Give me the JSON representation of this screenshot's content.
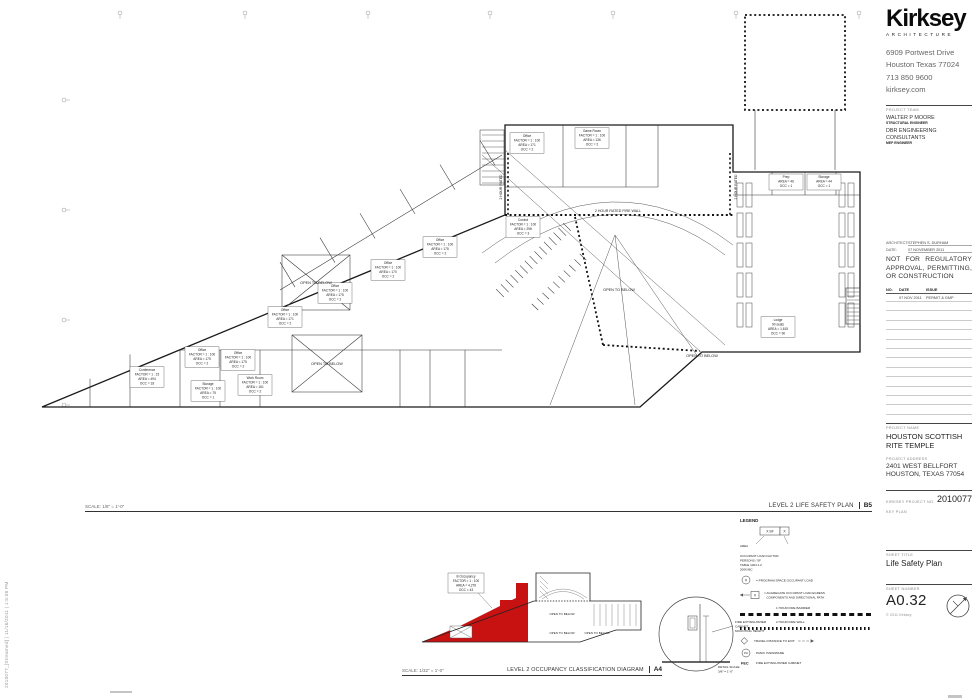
{
  "sheet": {
    "plot_stamp": "2010077_[Streamed] | 11/16/2011 | 1:5:08 PM",
    "copyright": "© 2011 Kirksey"
  },
  "firm": {
    "logo": "Kirksey",
    "logo_sub": "ARCHITECTURE",
    "address_lines": [
      "6909 Portwest Drive",
      "Houston Texas 77024",
      "713 850 9600",
      "kirksey.com"
    ]
  },
  "team": {
    "label": "PROJECT TEAM",
    "members": [
      {
        "name": "WALTER P MOORE",
        "role": "STRUCTURAL ENGINEER"
      },
      {
        "name": "DBR ENGINEERING CONSULTANTS",
        "role": "MEP ENGINEER"
      }
    ]
  },
  "stamp": {
    "architect_label": "ARCHITECT:",
    "architect": "STEPHEN S. DURHAM",
    "date_label": "DATE:",
    "date": "07 NOVEMBER 2011",
    "notice": "NOT FOR REGULATORY APPROVAL, PERMITTING, OR CONSTRUCTION"
  },
  "issues": {
    "headers": [
      "NO.",
      "DATE",
      "ISSUE"
    ],
    "rows": [
      {
        "no": "",
        "date": "07 NOV 2011",
        "issue": "PERMIT & GMP"
      }
    ],
    "blank_rows": 12
  },
  "project": {
    "name_label": "PROJECT NAME",
    "name": "HOUSTON SCOTTISH RITE TEMPLE",
    "address_label": "PROJECT ADDRESS",
    "address_lines": [
      "2401 WEST BELLFORT",
      "HOUSTON, TEXAS 77054"
    ],
    "number_label": "KIRKSEY PROJECT NO.",
    "number": "2010077",
    "key_plan_label": "KEY PLAN"
  },
  "sheet_info": {
    "title_label": "SHEET TITLE",
    "title": "Life Safety Plan",
    "number_label": "SHEET NUMBER",
    "number": "A0.32"
  },
  "main_plan": {
    "title": "LEVEL 2 LIFE SAFETY PLAN",
    "ref": "B5",
    "scale": "SCALE: 1/8\" = 1'-0\"",
    "fire_wall_label": "2 HOUR RATED FIRE WALL",
    "fire_rated_side_label": "2 HOUR RATED",
    "open_to_below_label": "OPEN TO BELOW",
    "rooms": [
      {
        "x": 117,
        "y": 372,
        "lines": [
          "Conference",
          "FACTOR = 1 : 15",
          "AREA = 494",
          "OCC = 33"
        ]
      },
      {
        "x": 172,
        "y": 352,
        "lines": [
          "Office",
          "FACTOR = 1 : 100",
          "AREA = 175",
          "OCC = 2"
        ]
      },
      {
        "x": 208,
        "y": 355,
        "lines": [
          "Office",
          "FACTOR = 1 : 100",
          "AREA = 175",
          "OCC = 2"
        ]
      },
      {
        "x": 225,
        "y": 380,
        "lines": [
          "Work Room",
          "FACTOR = 1 : 100",
          "AREA = 161",
          "OCC = 2"
        ]
      },
      {
        "x": 178,
        "y": 386,
        "lines": [
          "Storage",
          "FACTOR = 1 : 100",
          "AREA = 75",
          "OCC = 1"
        ]
      },
      {
        "x": 255,
        "y": 312,
        "lines": [
          "Office",
          "FACTOR = 1 : 100",
          "AREA = 171",
          "OCC = 2"
        ]
      },
      {
        "x": 305,
        "y": 288,
        "lines": [
          "Office",
          "FACTOR = 1 : 100",
          "AREA = 175",
          "OCC = 2"
        ]
      },
      {
        "x": 358,
        "y": 265,
        "lines": [
          "Office",
          "FACTOR = 1 : 100",
          "AREA = 170",
          "OCC = 2"
        ]
      },
      {
        "x": 410,
        "y": 242,
        "lines": [
          "Office",
          "FACTOR = 1 : 100",
          "AREA = 175",
          "OCC = 2"
        ]
      },
      {
        "x": 497,
        "y": 138,
        "lines": [
          "Office",
          "FACTOR = 1 : 100",
          "AREA = 171",
          "OCC = 2"
        ]
      },
      {
        "x": 562,
        "y": 133,
        "lines": [
          "Game Room",
          "FACTOR = 1 : 100",
          "AREA = 136",
          "OCC = 2"
        ]
      },
      {
        "x": 493,
        "y": 222,
        "lines": [
          "Control",
          "FACTOR = 1 : 100",
          "AREA = 298",
          "OCC = 3"
        ]
      },
      {
        "x": 748,
        "y": 322,
        "lines": [
          "Lodge",
          "90 seats",
          "AREA = 1,615",
          "OCC = 90"
        ]
      },
      {
        "x": 756,
        "y": 177,
        "lines": [
          "Prep",
          "AREA = 46",
          "OCC = 1"
        ]
      },
      {
        "x": 794,
        "y": 177,
        "lines": [
          "Storage",
          "AREA = 44",
          "OCC = 1"
        ]
      }
    ]
  },
  "occupancy_diagram": {
    "title": "LEVEL 2 OCCUPANCY CLASSIFICATION DIAGRAM",
    "ref": "A4",
    "scale": "SCALE: 1/32\" = 1'-0\"",
    "red_color": "#c81212",
    "b_tag_lines": [
      "B Occupancy",
      "FACTOR = 1 : 100",
      "AREA = 4,276",
      "OCC = 43"
    ],
    "open_to_below_label": "OPEN TO BELOW"
  },
  "legend": {
    "title": "LEGEND",
    "tag_left": "X SF",
    "tag_right": "X",
    "tag_arrow_label": "AREA",
    "tag_note_lines": [
      "OCCUPANT LOAD FACTOR",
      "PERSONS / SF",
      "TABLE 1004.1.2",
      "2006 IBC"
    ],
    "program_symbol": "#",
    "program_label": "= PROGRAM SPACE OCCUPANT LOAD",
    "aggregate_symbol": "#",
    "aggregate_label_lines": [
      "= AGGREGATE OCCUPANT LOAD EGRESS",
      "COMPONENTS AND DIRECTIONAL PATH"
    ],
    "fire_barrier_label": "1 HOUR FIRE BARRIER",
    "fire_wall_label": "2 HOUR FIRE WALL",
    "travel_label": "TRAVEL DISTANCE TO EXIT",
    "panic_symbol": "PH",
    "panic_label": "PANIC HARDWARE",
    "fec_symbol": "FEC",
    "fec_label": "FIRE EXTINGUISHER CABINET"
  },
  "detail": {
    "label_lines": [
      "FIRE EXTINGUISHER",
      "CABINET",
      "MOUNTING HEIGHT"
    ],
    "scale_label": "DETAIL SCALE:",
    "scale_value": "3/8\" = 1'-0\""
  }
}
